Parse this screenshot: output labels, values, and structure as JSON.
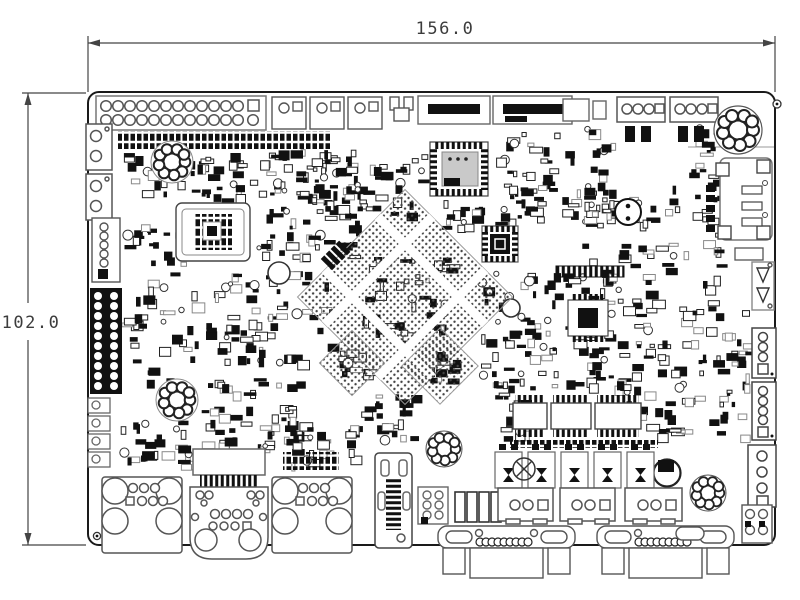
{
  "drawing": {
    "type": "pcb-mechanical-assembly-drawing",
    "width_label": "156.0",
    "height_label": "102.0",
    "board_width_mm": 156.0,
    "board_height_mm": 102.0,
    "ink_color": "#1a1a1a",
    "dim_color": "#3c3c3c",
    "background": "#ffffff"
  },
  "components": [
    "pin-header-2x13",
    "gpio-pin-strip",
    "audio-jack-1",
    "audio-jack-2",
    "wafer-connector-left",
    "pin-header-2col",
    "toroid-inductor-1",
    "toroid-inductor-2",
    "toroid-inductor-3",
    "toroid-inductor-4",
    "toroid-inductor-5",
    "qfp-chip",
    "qfn-chip-1",
    "qfn-chip-2",
    "bga-chip-main",
    "bga-chip-small-1",
    "bga-chip-small-2",
    "buzzer",
    "card-slot",
    "wafer-connector-right-1",
    "wafer-connector-right-2",
    "wafer-connector-right-3",
    "right-edge-connector",
    "bottom-connector-a",
    "bottom-connector-b",
    "bottom-connector-c",
    "vertical-connector",
    "dsub-connector-1",
    "dsub-connector-2",
    "wafer-connector-bottom-1",
    "wafer-connector-bottom-2",
    "wafer-connector-bottom-3",
    "bar-component",
    "wafer-6pin",
    "diode-array",
    "soic-chip-1",
    "soic-chip-2",
    "soic-chip-3",
    "crystal-circle",
    "cap-circle",
    "top-edge-connectors",
    "corner-holes"
  ],
  "noise_clusters": [
    [
      118,
      152,
      225,
      48,
      80
    ],
    [
      115,
      222,
      80,
      160,
      55
    ],
    [
      258,
      148,
      100,
      108,
      65
    ],
    [
      205,
      268,
      125,
      95,
      65
    ],
    [
      200,
      372,
      112,
      88,
      55
    ],
    [
      340,
      152,
      85,
      62,
      38
    ],
    [
      480,
      272,
      75,
      115,
      55
    ],
    [
      495,
      132,
      62,
      90,
      45
    ],
    [
      562,
      242,
      125,
      135,
      85
    ],
    [
      562,
      128,
      50,
      100,
      32
    ],
    [
      688,
      128,
      34,
      55,
      18
    ],
    [
      688,
      300,
      60,
      142,
      42
    ],
    [
      622,
      382,
      66,
      52,
      26
    ],
    [
      358,
      392,
      55,
      52,
      24
    ],
    [
      120,
      418,
      92,
      50,
      34
    ],
    [
      258,
      422,
      95,
      44,
      26
    ],
    [
      495,
      378,
      26,
      60,
      18
    ],
    [
      432,
      200,
      52,
      28,
      14
    ],
    [
      578,
      182,
      105,
      42,
      30
    ],
    [
      690,
      192,
      28,
      95,
      16
    ],
    [
      362,
      254,
      86,
      86,
      58
    ],
    [
      338,
      350,
      28,
      26,
      12
    ],
    [
      426,
      352,
      28,
      28,
      12
    ],
    [
      540,
      370,
      85,
      20,
      14
    ]
  ]
}
